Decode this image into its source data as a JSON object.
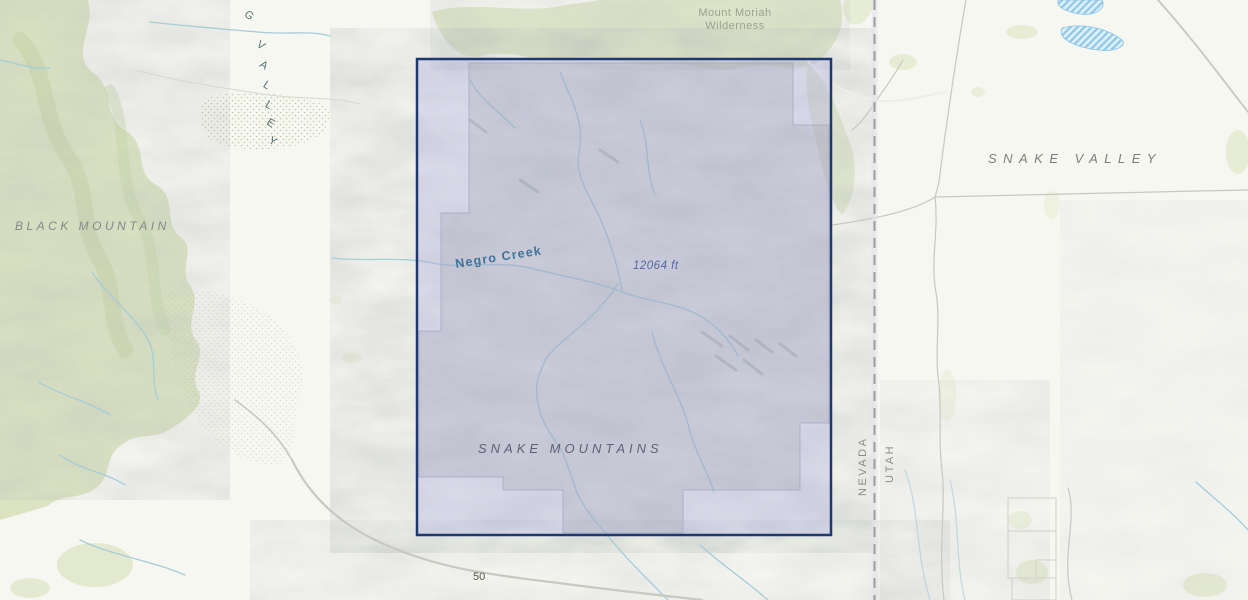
{
  "map": {
    "labels": {
      "mount_moriah_line1": "Mount Moriah",
      "mount_moriah_line2": "Wilderness",
      "snake_valley": "SNAKE VALLEY",
      "black_mountain": "BLACK MOUNTAIN",
      "snake_mountains": "SNAKE MOUNTAINS",
      "spring_valley_letters": [
        "G",
        "V",
        "A",
        "L",
        "L",
        "E",
        "Y"
      ],
      "nevada": "NEVADA",
      "utah": "UTAH",
      "negro_creek": "Negro Creek",
      "spot_elevation": "12064 ft",
      "highway_50": "50"
    },
    "colors": {
      "selection_border": "#1c3a6e",
      "selection_fill": "rgba(172,169,226,0.32)",
      "boundary_fill": "rgba(125,140,120,0.20)",
      "boundary_stroke": "#98a2ae",
      "water": "#a4cdd8",
      "water_label": "#3e739b",
      "elevation_label": "#5767a6",
      "road": "#c8c8c1",
      "state_line": "#9c9ca4",
      "terrain_label": "#85858a",
      "vegetation": "#dde4c4",
      "lake_hatch": "#90c8e8",
      "background": "#f7f7f2"
    }
  }
}
